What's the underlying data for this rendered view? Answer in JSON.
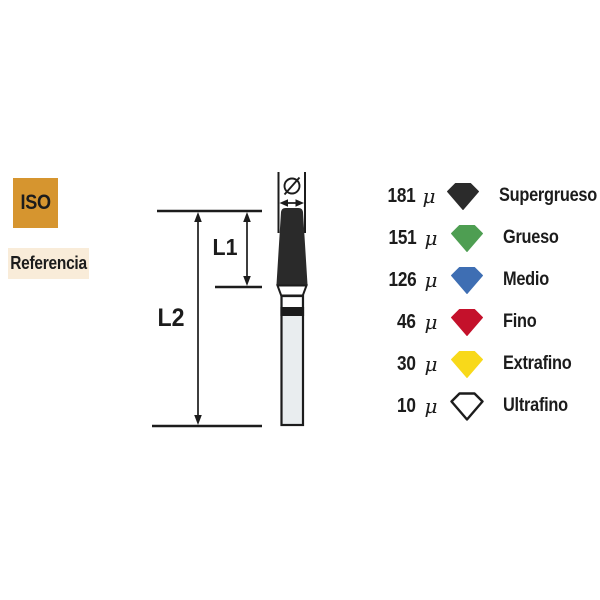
{
  "badges": {
    "iso": {
      "label": "ISO",
      "bg": "#d6952f"
    },
    "referencia": {
      "label": "Referencia",
      "bg": "#f9ecd9"
    }
  },
  "diagram": {
    "labels": {
      "l1": "L1",
      "l2": "L2",
      "diameter_symbol": "Ø"
    },
    "bur_colors": {
      "working_tip": "#2a2a2a",
      "shank_fill": "#e9edef",
      "collar_band": "#1a1a1a",
      "outline": "#1c1c1c"
    }
  },
  "legend": {
    "unit": "μ",
    "items": [
      {
        "size": "181",
        "grit": "Supergrueso",
        "color": "#2b2b2b"
      },
      {
        "size": "151",
        "grit": "Grueso",
        "color": "#4e9e52"
      },
      {
        "size": "126",
        "grit": "Medio",
        "color": "#3e6eb3"
      },
      {
        "size": "46",
        "grit": "Fino",
        "color": "#c4112b"
      },
      {
        "size": "30",
        "grit": "Extrafino",
        "color": "#f8d91a"
      },
      {
        "size": "10",
        "grit": "Ultrafino",
        "color": "#ffffff",
        "outline": "#1c1c1c"
      }
    ]
  }
}
